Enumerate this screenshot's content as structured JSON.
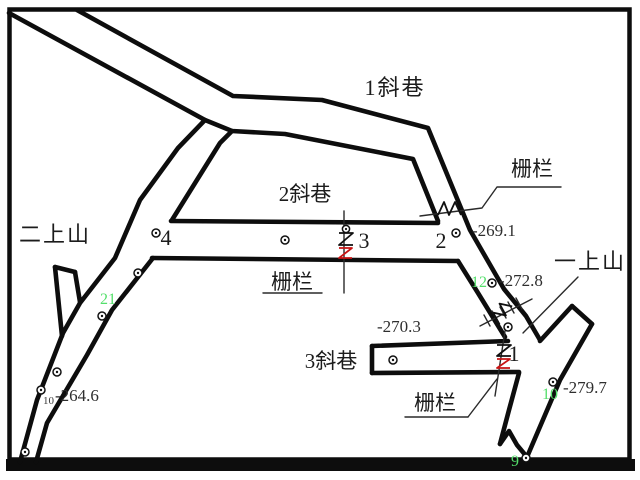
{
  "drawing_type": "mine-roadway-plan",
  "colors": {
    "ink": "#0d0d0d",
    "label_text": "#1c1c1c",
    "elevation_text": "#2e2e2e",
    "station_green": "#54df6b",
    "barrier_red": "#c81414",
    "background": "#ffffff"
  },
  "labels": {
    "incline1": "1斜巷",
    "incline2": "2斜巷",
    "incline3": "3斜巷",
    "rise_two": "二上山",
    "rise_one": "一上山",
    "barrier_top": "栅栏",
    "barrier_mid": "栅栏",
    "barrier_bottom": "栅栏"
  },
  "elevations": {
    "e1": "-269.1",
    "e2": "-272.8",
    "e3": "-270.3",
    "e4": "-264.6",
    "e5": "-279.7"
  },
  "stations": {
    "black4": "4",
    "black3": "3",
    "black2": "2",
    "black1": "1",
    "green21": "21",
    "green12": "12",
    "green10": "10",
    "green9": "9",
    "small10": "10"
  }
}
